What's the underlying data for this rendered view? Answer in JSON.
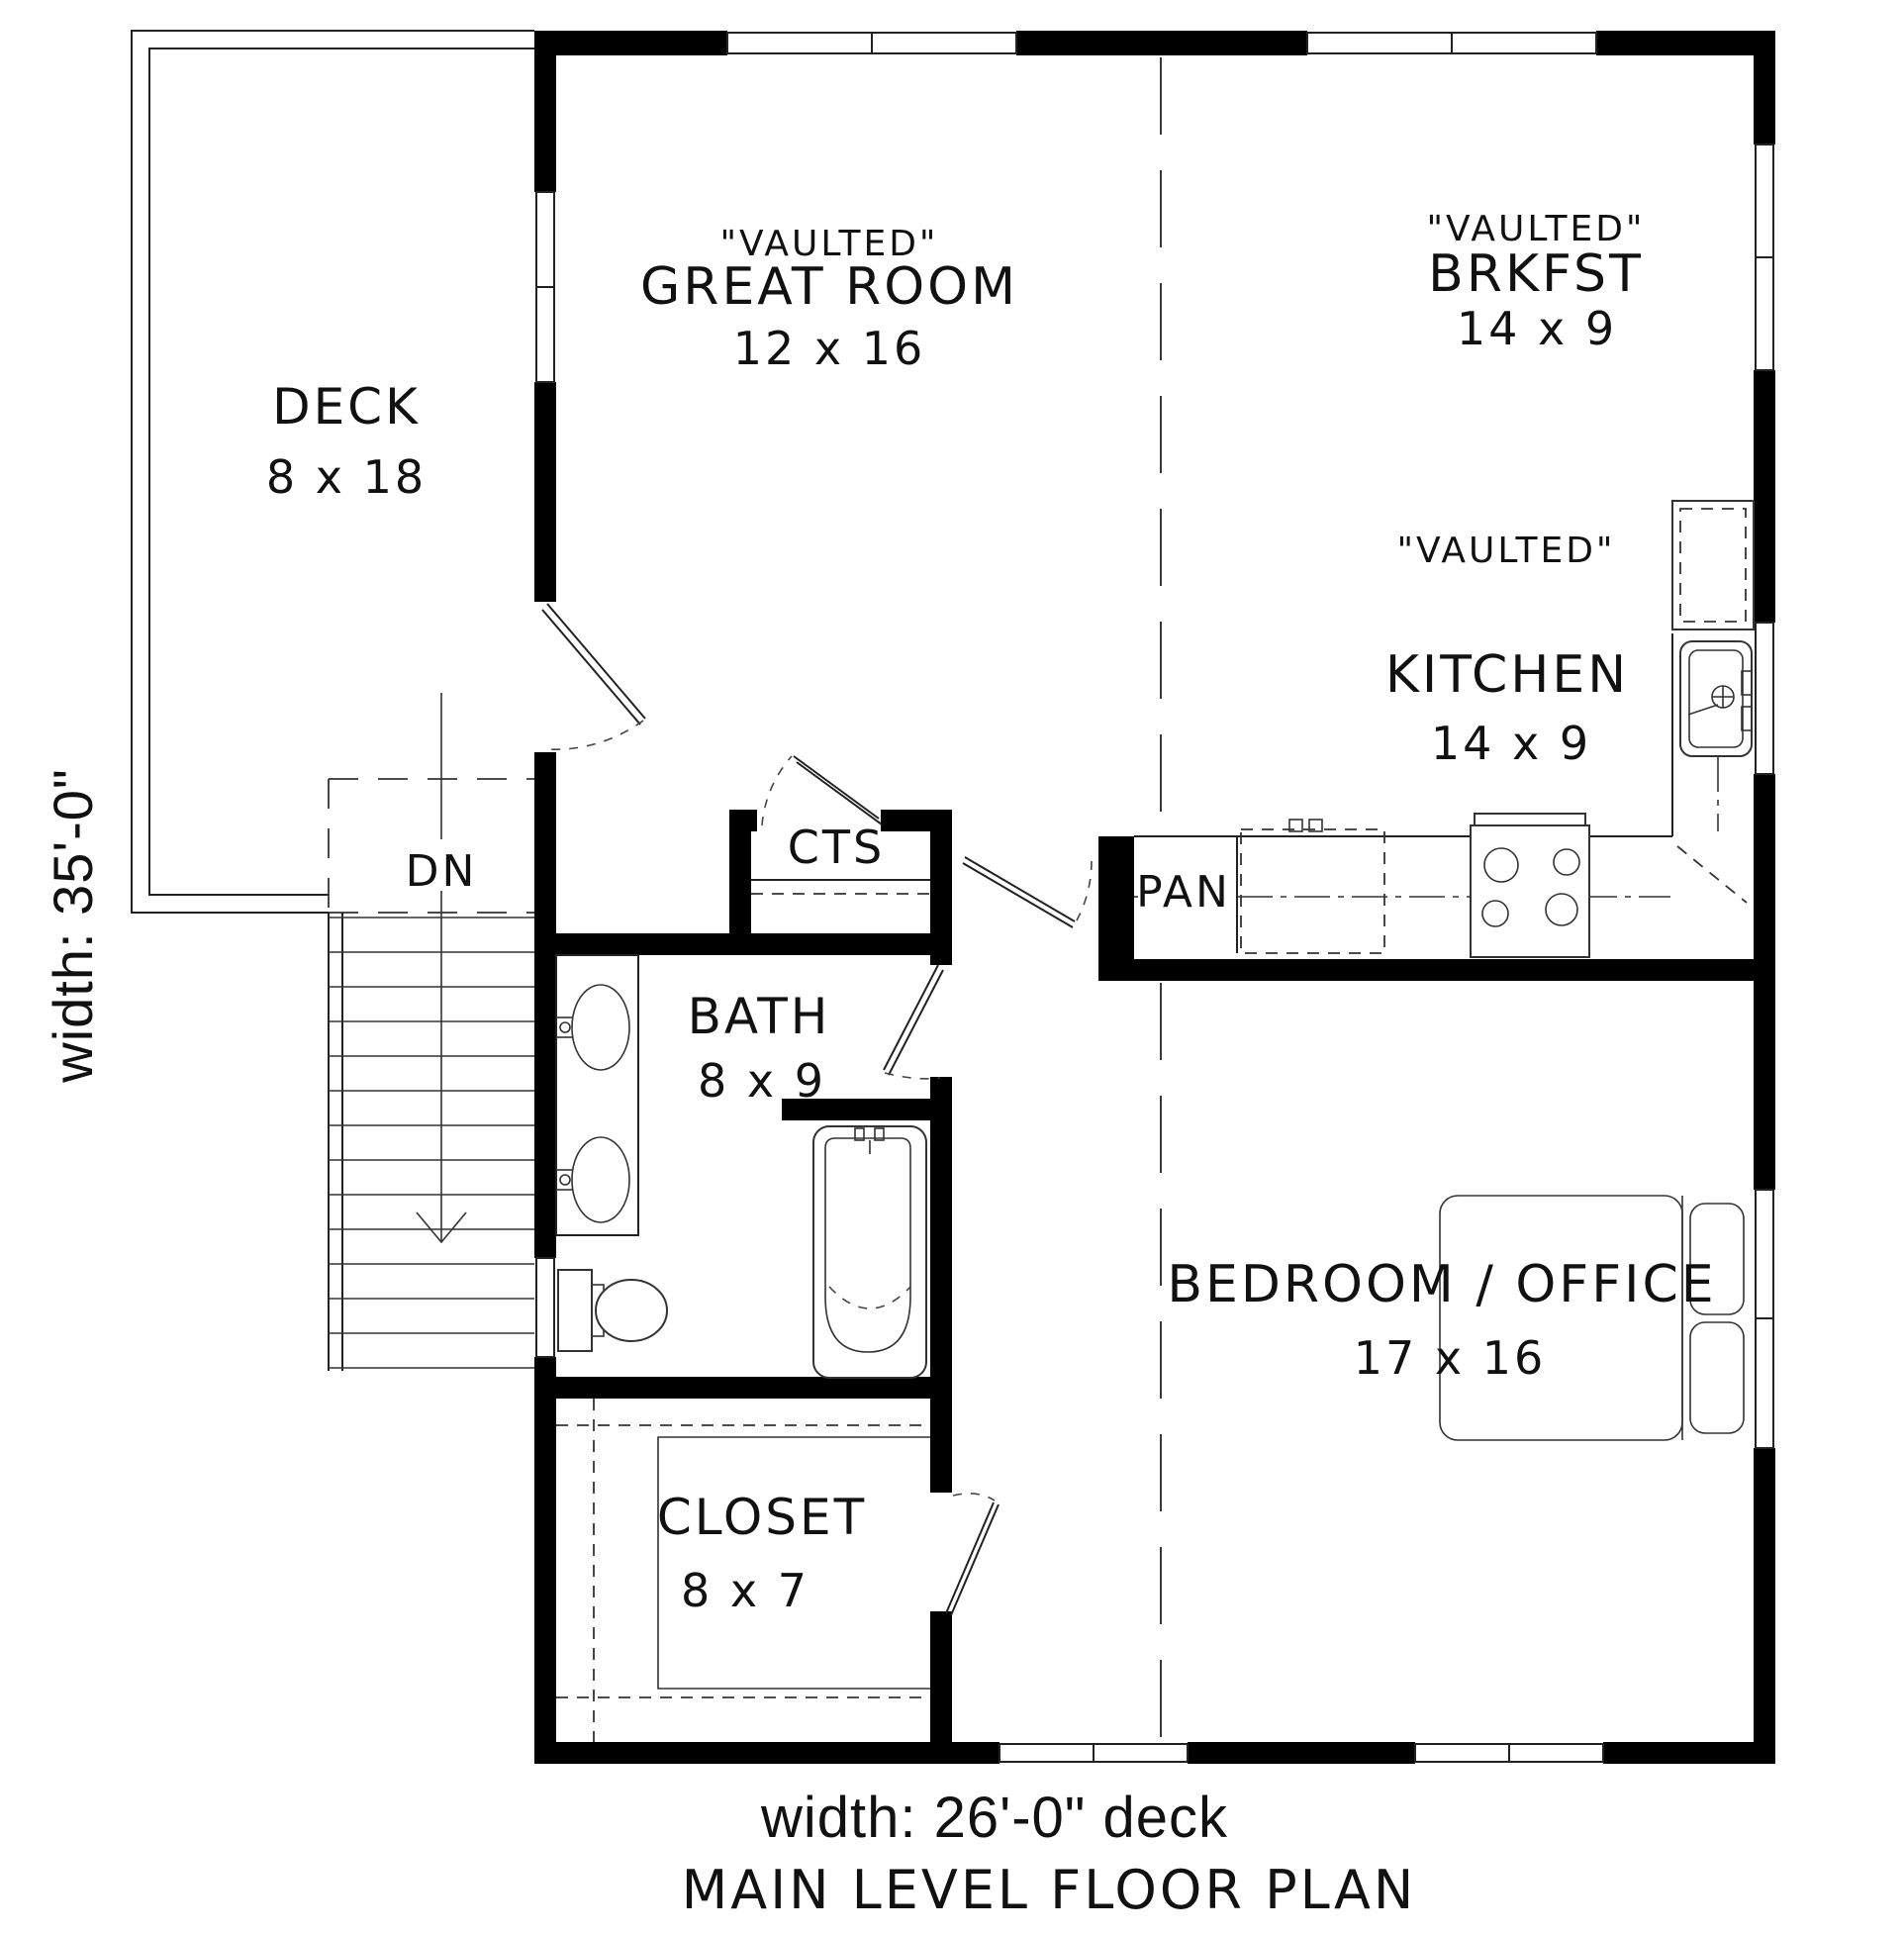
{
  "plan": {
    "rooms": {
      "deck": {
        "name": "DECK",
        "dims": "8 x 18"
      },
      "great_room": {
        "note": "\"VAULTED\"",
        "name": "GREAT ROOM",
        "dims": "12 x 16"
      },
      "brkfst": {
        "note": "\"VAULTED\"",
        "name": "BRKFST",
        "dims": "14 x 9"
      },
      "kitchen": {
        "note": "\"VAULTED\"",
        "name": "KITCHEN",
        "dims": "14 x 9"
      },
      "bath": {
        "name": "BATH",
        "dims": "8 x 9"
      },
      "bedroom_office": {
        "name": "BEDROOM / OFFICE",
        "dims": "17 x 16"
      },
      "closet": {
        "name": "CLOSET",
        "dims": "8 x 7"
      }
    },
    "labels": {
      "cts": "CTS",
      "pan": "PAN",
      "stairs_down": "DN"
    },
    "dimensions": {
      "side": "width: 35'-0\"",
      "bottom": "width: 26'-0\" deck"
    },
    "title": "MAIN LEVEL FLOOR PLAN",
    "colors": {
      "wall": "#000000",
      "line": "#222222",
      "background": "#ffffff"
    }
  }
}
